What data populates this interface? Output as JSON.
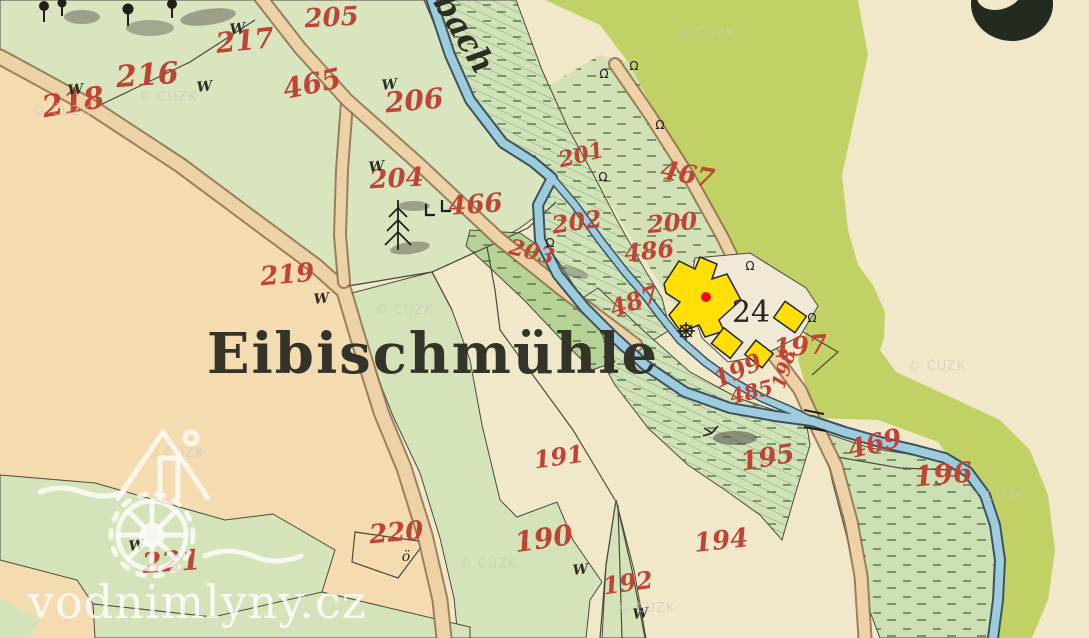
{
  "map": {
    "title": "Eibischmühle",
    "stream_label": "bach",
    "mill_house_number": "24",
    "garden_symbol": "ö",
    "meadow_symbol": "W",
    "sluice_symbol": "Ω",
    "parcels": [
      {
        "n": "218",
        "x": 75,
        "y": 112,
        "r": -10,
        "s": 30
      },
      {
        "n": "216",
        "x": 148,
        "y": 85,
        "r": -4,
        "s": 30
      },
      {
        "n": "217",
        "x": 246,
        "y": 50,
        "r": -6,
        "s": 28
      },
      {
        "n": "205",
        "x": 332,
        "y": 26,
        "r": -3,
        "s": 26
      },
      {
        "n": "465",
        "x": 314,
        "y": 93,
        "r": -12,
        "s": 28
      },
      {
        "n": "206",
        "x": 415,
        "y": 110,
        "r": -5,
        "s": 28
      },
      {
        "n": "204",
        "x": 397,
        "y": 187,
        "r": -3,
        "s": 26
      },
      {
        "n": "466",
        "x": 476,
        "y": 213,
        "r": -4,
        "s": 26
      },
      {
        "n": "203",
        "x": 530,
        "y": 259,
        "r": 14,
        "s": 22
      },
      {
        "n": "219",
        "x": 288,
        "y": 283,
        "r": -5,
        "s": 26
      },
      {
        "n": "201",
        "x": 583,
        "y": 162,
        "r": -14,
        "s": 22
      },
      {
        "n": "202",
        "x": 578,
        "y": 230,
        "r": -8,
        "s": 24
      },
      {
        "n": "200",
        "x": 673,
        "y": 231,
        "r": -5,
        "s": 24
      },
      {
        "n": "467",
        "x": 686,
        "y": 183,
        "r": 10,
        "s": 26
      },
      {
        "n": "486",
        "x": 650,
        "y": 259,
        "r": -6,
        "s": 24
      },
      {
        "n": "487",
        "x": 637,
        "y": 309,
        "r": -20,
        "s": 24
      },
      {
        "n": "197",
        "x": 801,
        "y": 355,
        "r": -5,
        "s": 26
      },
      {
        "n": "199",
        "x": 741,
        "y": 378,
        "r": -24,
        "s": 24
      },
      {
        "n": "198",
        "x": 790,
        "y": 371,
        "r": -72,
        "s": 19
      },
      {
        "n": "485",
        "x": 753,
        "y": 399,
        "r": -14,
        "s": 21
      },
      {
        "n": "469",
        "x": 877,
        "y": 452,
        "r": -14,
        "s": 26
      },
      {
        "n": "196",
        "x": 944,
        "y": 484,
        "r": -5,
        "s": 28
      },
      {
        "n": "195",
        "x": 769,
        "y": 466,
        "r": -10,
        "s": 26
      },
      {
        "n": "194",
        "x": 722,
        "y": 549,
        "r": -6,
        "s": 26
      },
      {
        "n": "191",
        "x": 560,
        "y": 465,
        "r": -8,
        "s": 24
      },
      {
        "n": "190",
        "x": 545,
        "y": 548,
        "r": -8,
        "s": 28
      },
      {
        "n": "192",
        "x": 629,
        "y": 591,
        "r": -8,
        "s": 24
      },
      {
        "n": "220",
        "x": 397,
        "y": 541,
        "r": -5,
        "s": 26
      },
      {
        "n": "221",
        "x": 172,
        "y": 571,
        "r": -4,
        "s": 28
      }
    ],
    "meadow_marks": [
      {
        "x": 76,
        "y": 94
      },
      {
        "x": 238,
        "y": 33
      },
      {
        "x": 205,
        "y": 91
      },
      {
        "x": 390,
        "y": 89
      },
      {
        "x": 377,
        "y": 171
      },
      {
        "x": 322,
        "y": 303
      },
      {
        "x": 581,
        "y": 574
      },
      {
        "x": 641,
        "y": 618
      },
      {
        "x": 137,
        "y": 550
      }
    ],
    "garden_mark": {
      "x": 406,
      "y": 559
    },
    "sluice_marks": [
      {
        "x": 604,
        "y": 78
      },
      {
        "x": 634,
        "y": 70
      },
      {
        "x": 660,
        "y": 129
      },
      {
        "x": 603,
        "y": 181
      },
      {
        "x": 550,
        "y": 247
      },
      {
        "x": 750,
        "y": 270
      },
      {
        "x": 812,
        "y": 322
      }
    ]
  },
  "watermark": {
    "copyright_text": "© ČÚZK",
    "positions": [
      {
        "x": 706,
        "y": 37
      },
      {
        "x": 168,
        "y": 101
      },
      {
        "x": 62,
        "y": 115
      },
      {
        "x": 404,
        "y": 314
      },
      {
        "x": 175,
        "y": 457
      },
      {
        "x": 937,
        "y": 370
      },
      {
        "x": 996,
        "y": 500
      },
      {
        "x": 646,
        "y": 612
      },
      {
        "x": 488,
        "y": 568
      }
    ],
    "site_text": "vodnimlyny.cz"
  },
  "colors": {
    "paper": "#f1e8ca",
    "peach": "#f5dcb0",
    "field_green": "#d8e5bf",
    "meadow_green": "#cfe2b8",
    "dense_green": "#b7d295",
    "olive": "#c2d166",
    "stream_fill": "#9fccdd",
    "stream_edge": "#3a535e",
    "road_fill": "#edd2a7",
    "road_edge": "#8d6e49",
    "building_yellow": "#ffdf05",
    "mill_marker_red": "#e81111",
    "parcel_number_red": "#bf4435",
    "ink": "#2e2e25"
  }
}
